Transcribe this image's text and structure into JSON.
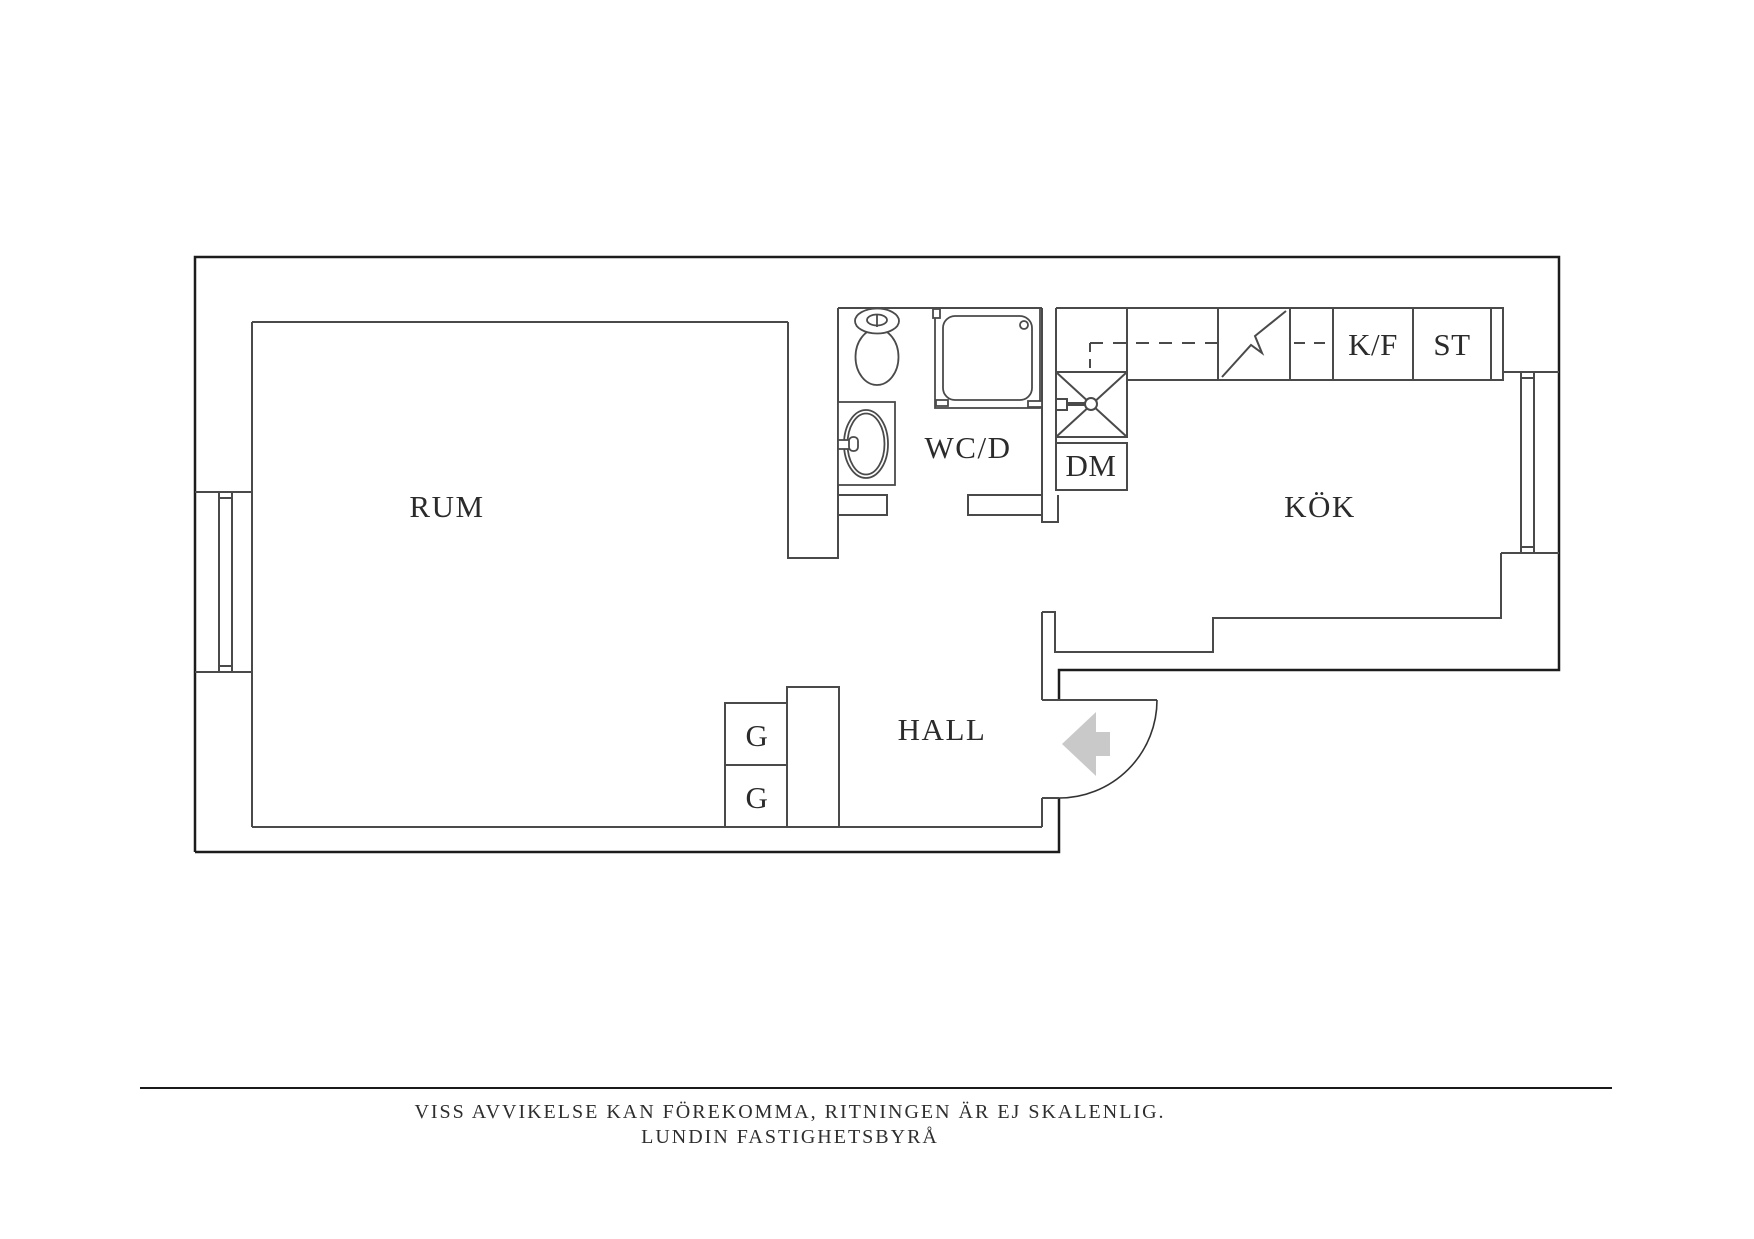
{
  "title": "Apartment floor plan",
  "labels": {
    "rum": "RUM",
    "wcd": "WC/D",
    "kok": "KÖK",
    "hall": "HALL",
    "dm": "DM",
    "kf": "K/F",
    "st": "ST",
    "g_upper": "G",
    "g_lower": "G"
  },
  "fixtures": [
    "toilet",
    "washbasin",
    "shower",
    "kitchen-sink",
    "stove",
    "dishwasher",
    "fridge-freezer",
    "tall-storage",
    "wardrobe-upper",
    "wardrobe-lower",
    "entrance-door",
    "entrance-arrow",
    "window-left",
    "window-right"
  ],
  "footer": {
    "disclaimer": "VISS AVVIKELSE KAN FÖREKOMMA, RITNINGEN ÄR EJ SKALENLIG.",
    "agency": "LUNDIN FASTIGHETSBYRÅ"
  },
  "colors": {
    "wall_outer": "#1c1c1c",
    "wall_inner": "#4a4a4a",
    "fixture_line": "#4a4a4a",
    "entrance_arrow": "#c9c9c9",
    "text": "#2b2b2b",
    "background": "#ffffff"
  }
}
